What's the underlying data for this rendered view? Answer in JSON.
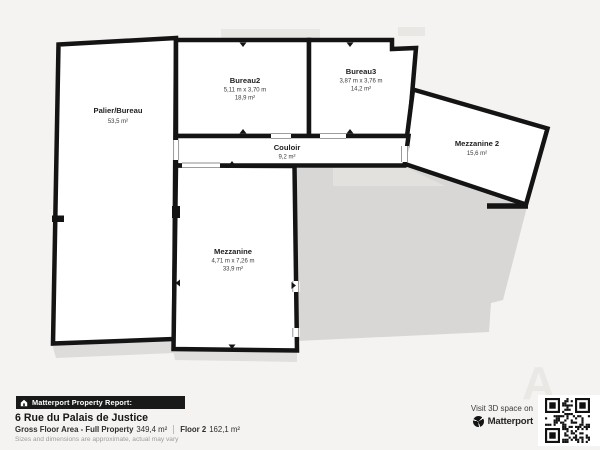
{
  "plan": {
    "rooms": [
      {
        "name": "Palier/Bureau",
        "dims": "",
        "area": "53,5 m²"
      },
      {
        "name": "Bureau2",
        "dims": "5,11 m x 3,70 m",
        "area": "18,9 m²"
      },
      {
        "name": "Bureau3",
        "dims": "3,87 m x 3,76 m",
        "area": "14,2 m²"
      },
      {
        "name": "Couloir",
        "dims": "",
        "area": "9,2 m²"
      },
      {
        "name": "Mezzanine",
        "dims": "4,71 m x 7,26 m",
        "area": "33,9 m²"
      },
      {
        "name": "Mezzanine 2",
        "dims": "",
        "area": "15,6 m²"
      }
    ]
  },
  "footer": {
    "report_badge": "Matterport Property Report:",
    "address": "6 Rue du Palais de Justice",
    "gross_label": "Gross Floor Area - Full Property",
    "gross_value": "349,4 m²",
    "floor_label": "Floor 2",
    "floor_value": "162,1 m²",
    "disclaimer": "Sizes and dimensions are approximate, actual may vary",
    "visit_text": "Visit 3D space on",
    "brand": "Matterport",
    "watermark": "A"
  },
  "colors": {
    "background": "#f4f3f1",
    "wall": "#141414",
    "room_fill": "#ffffff",
    "shadow": "#d8d7d5",
    "shadow_light": "#e4e3e0",
    "badge_bg": "#191919"
  }
}
